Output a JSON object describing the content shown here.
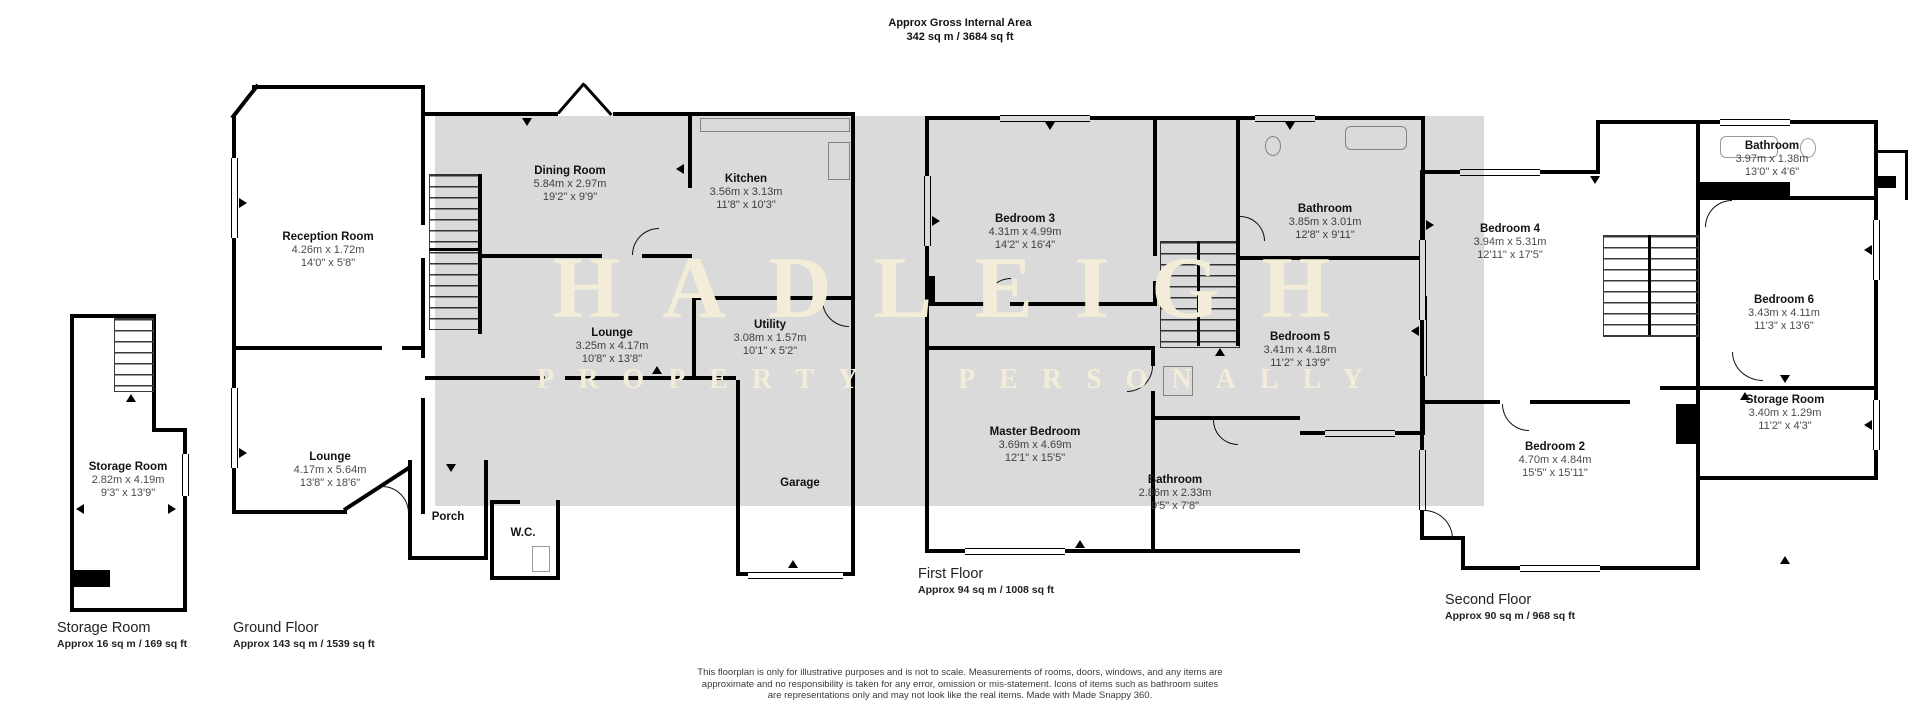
{
  "header": {
    "title": "Approx Gross Internal Area",
    "subtitle": "342 sq m / 3684 sq ft"
  },
  "watermark": {
    "line1": "HADLEIGH",
    "line2": "PROPERTY PERSONALLY",
    "text_color": "#f3ecd8",
    "band_color": "rgba(0,0,0,0.145)"
  },
  "floor_labels": {
    "storage": {
      "title": "Storage Room",
      "area": "Approx 16 sq m / 169 sq ft"
    },
    "ground": {
      "title": "Ground Floor",
      "area": "Approx 143 sq m / 1539 sq ft"
    },
    "first": {
      "title": "First Floor",
      "area": "Approx 94 sq m / 1008 sq ft"
    },
    "second": {
      "title": "Second Floor",
      "area": "Approx 90 sq m / 968 sq ft"
    }
  },
  "rooms": {
    "storage_left": {
      "name": "Storage Room",
      "metric": "2.82m x 4.19m",
      "imperial": "9'3\" x 13'9\""
    },
    "reception": {
      "name": "Reception Room",
      "metric": "4.26m x 1.72m",
      "imperial": "14'0\" x 5'8\""
    },
    "lounge_front": {
      "name": "Lounge",
      "metric": "4.17m x 5.64m",
      "imperial": "13'8\" x 18'6\""
    },
    "dining": {
      "name": "Dining Room",
      "metric": "5.84m x 2.97m",
      "imperial": "19'2\" x 9'9\""
    },
    "kitchen": {
      "name": "Kitchen",
      "metric": "3.56m x 3.13m",
      "imperial": "11'8\" x 10'3\""
    },
    "lounge_mid": {
      "name": "Lounge",
      "metric": "3.25m x 4.17m",
      "imperial": "10'8\" x 13'8\""
    },
    "utility": {
      "name": "Utility",
      "metric": "3.08m x 1.57m",
      "imperial": "10'1\" x 5'2\""
    },
    "porch": {
      "name": "Porch"
    },
    "wc": {
      "name": "W.C."
    },
    "garage": {
      "name": "Garage"
    },
    "bedroom3": {
      "name": "Bedroom 3",
      "metric": "4.31m x 4.99m",
      "imperial": "14'2\" x 16'4\""
    },
    "bathroom_f1": {
      "name": "Bathroom",
      "metric": "3.85m x 3.01m",
      "imperial": "12'8\" x 9'11\""
    },
    "bedroom5": {
      "name": "Bedroom 5",
      "metric": "3.41m x 4.18m",
      "imperial": "11'2\" x 13'9\""
    },
    "master": {
      "name": "Master Bedroom",
      "metric": "3.69m x 4.69m",
      "imperial": "12'1\" x 15'5\""
    },
    "bathroom_f1b": {
      "name": "Bathroom",
      "metric": "2.86m x 2.33m",
      "imperial": "9'5\" x 7'8\""
    },
    "bedroom4": {
      "name": "Bedroom 4",
      "metric": "3.94m x 5.31m",
      "imperial": "12'11\" x 17'5\""
    },
    "bathroom_f2": {
      "name": "Bathroom",
      "metric": "3.97m x 1.38m",
      "imperial": "13'0\" x 4'6\""
    },
    "bedroom6": {
      "name": "Bedroom 6",
      "metric": "3.43m x 4.11m",
      "imperial": "11'3\" x 13'6\""
    },
    "storage_f2": {
      "name": "Storage Room",
      "metric": "3.40m x 1.29m",
      "imperial": "11'2\" x 4'3\""
    },
    "bedroom2": {
      "name": "Bedroom 2",
      "metric": "4.70m x 4.84m",
      "imperial": "15'5\" x 15'11\""
    }
  },
  "disclaimer": {
    "line1": "This floorplan is only for illustrative purposes and is not to scale. Measurements of rooms, doors, windows, and any items are",
    "line2": "approximate and no responsibility is taken for any error, omission or mis-statement. Icons of items such as bathroom suites",
    "line3": "are representations only and may not look like the real items. Made with Made Snappy 360."
  }
}
